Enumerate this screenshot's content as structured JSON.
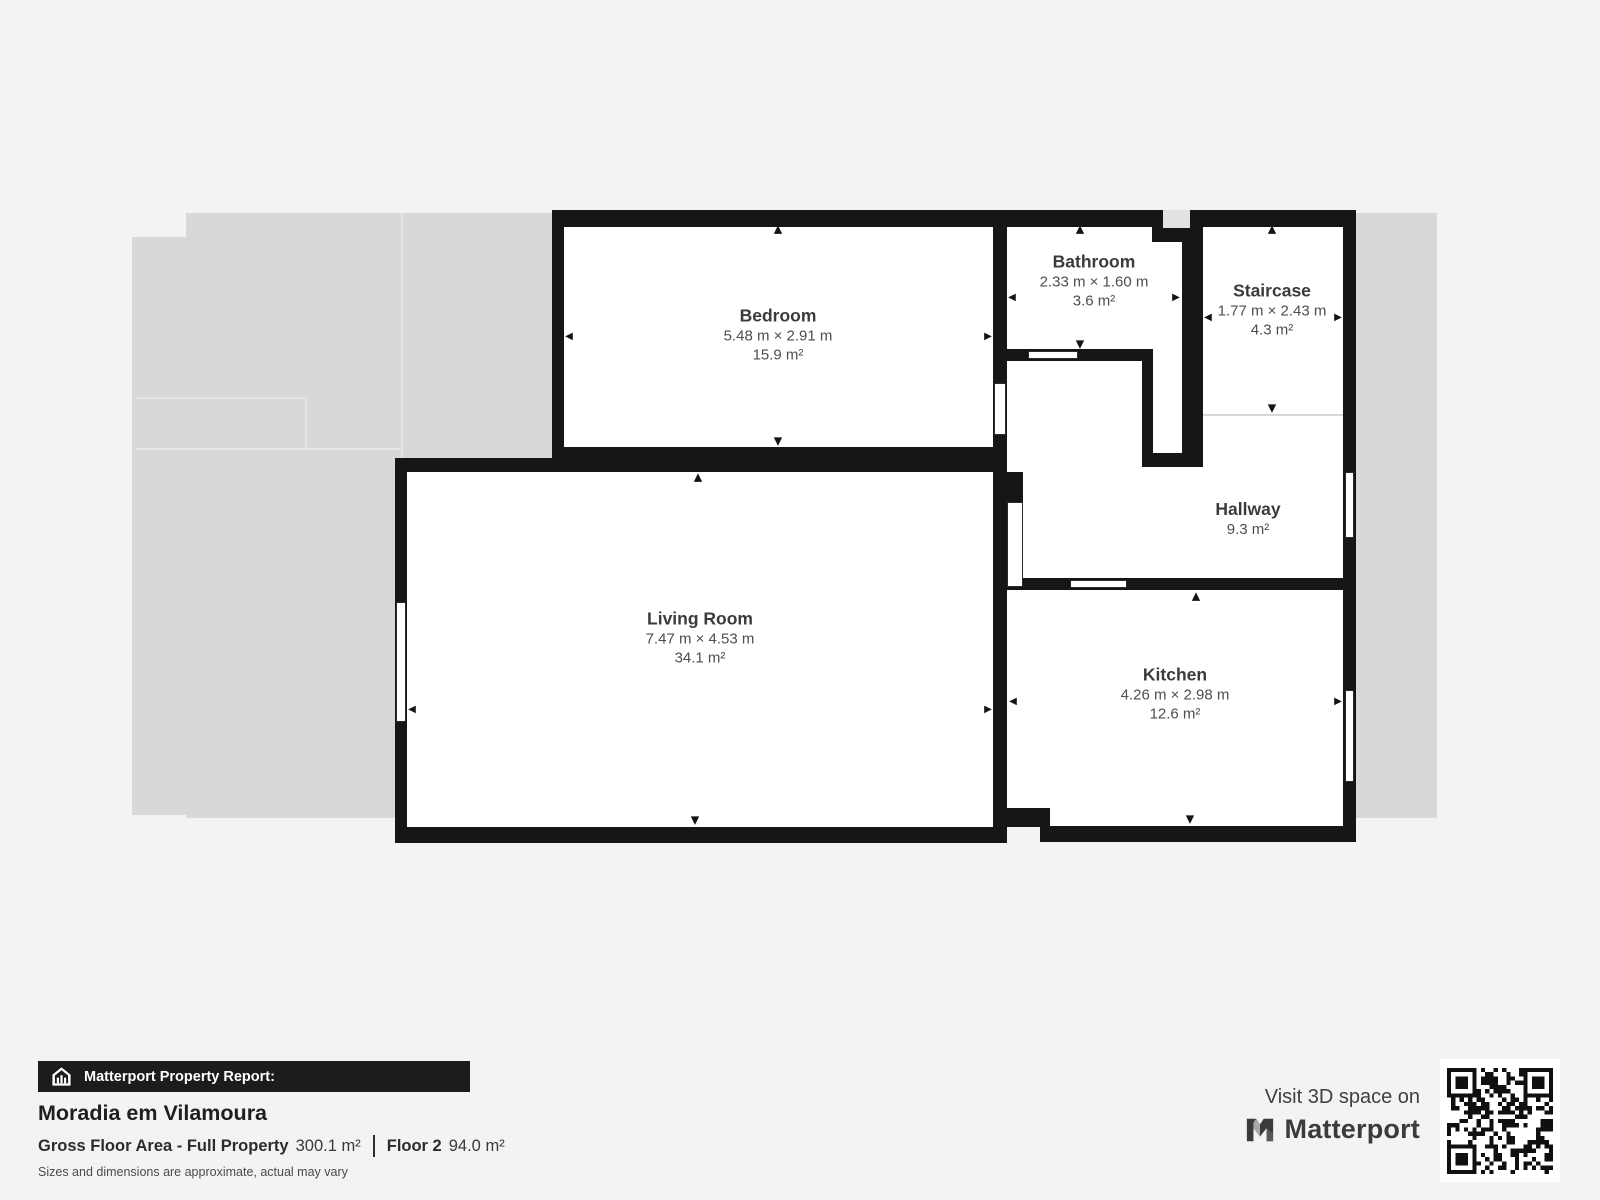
{
  "floorplan": {
    "rooms": [
      {
        "id": "bedroom",
        "name": "Bedroom",
        "dimensions": "5.48 m × 2.91 m",
        "area": "15.9 m²"
      },
      {
        "id": "bathroom",
        "name": "Bathroom",
        "dimensions": "2.33 m × 1.60 m",
        "area": "3.6 m²"
      },
      {
        "id": "staircase",
        "name": "Staircase",
        "dimensions": "1.77 m × 2.43 m",
        "area": "4.3 m²"
      },
      {
        "id": "hallway",
        "name": "Hallway",
        "dimensions": "",
        "area": "9.3 m²"
      },
      {
        "id": "living-room",
        "name": "Living Room",
        "dimensions": "7.47 m × 4.53 m",
        "area": "34.1 m²"
      },
      {
        "id": "kitchen",
        "name": "Kitchen",
        "dimensions": "4.26 m × 2.98 m",
        "area": "12.6 m²"
      }
    ]
  },
  "report": {
    "banner": "Matterport Property Report:",
    "property_name": "Moradia em Vilamoura",
    "gross_label": "Gross Floor Area - Full Property",
    "gross_value": "300.1 m²",
    "floor_label": "Floor 2",
    "floor_value": "94.0 m²",
    "disclaimer": "Sizes and dimensions are approximate, actual may vary"
  },
  "promo": {
    "visit_text": "Visit 3D space on",
    "brand": "Matterport"
  },
  "colors": {
    "wall": "#161616",
    "silhouette": "#d8d8d8",
    "background": "#f4f3f1",
    "banner_bg": "#1d1b1b"
  }
}
